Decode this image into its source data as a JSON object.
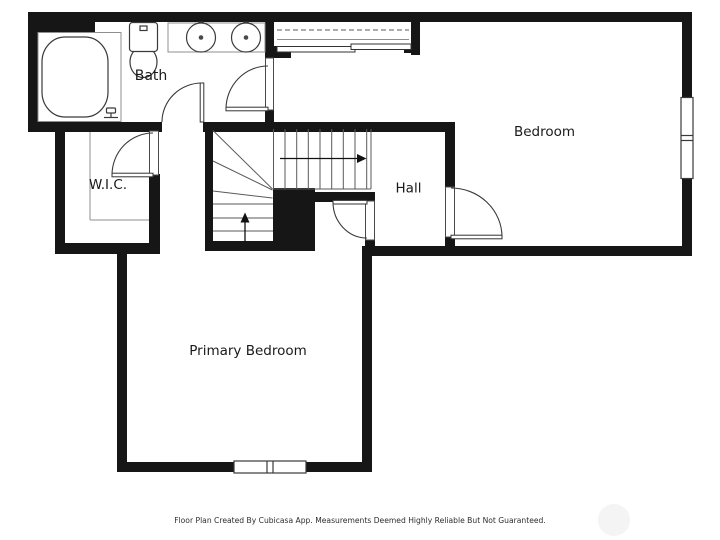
{
  "rooms": {
    "bath": "Bath",
    "wic": "W.I.C.",
    "hall": "Hall",
    "bedroom": "Bedroom",
    "primary_bedroom": "Primary Bedroom"
  },
  "footer": {
    "disclaimer": "Floor Plan Created By Cubicasa App. Measurements Deemed Highly Reliable But Not Guaranteed."
  },
  "fixtures": {
    "bathtub": "bathtub",
    "toilet": "toilet",
    "vanity": "double-sink-vanity",
    "closet": "closet-with-rod-and-sliding-doors",
    "stairs": "winder-staircase-with-up-arrows",
    "windows": "double-pane-windows",
    "doors": "hinged-swing-doors"
  },
  "colors": {
    "wall": "#161616",
    "fixture_line": "#3a3a3a",
    "thin_line": "#8f8f8f",
    "background": "#ffffff",
    "label": "#1a1a1a",
    "watermark": "#f4f4f4"
  }
}
